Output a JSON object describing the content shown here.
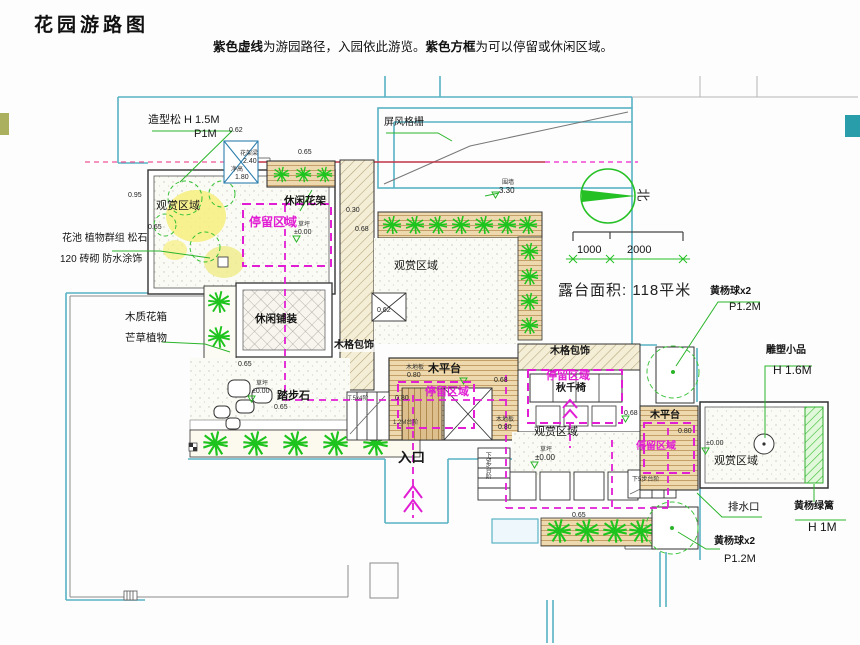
{
  "title": "花园游路图",
  "legend": {
    "bold1": "紫色虚线",
    "text1": "为游园路径，入园依此游览。",
    "bold2": "紫色方框",
    "text2": "为可以停留或休闲区域。"
  },
  "stats": {
    "terrace_area": "露台面积: 118平米"
  },
  "scalebar": {
    "left": "1000",
    "right": "2000"
  },
  "compass": {
    "north": "北"
  },
  "labels": {
    "zaoxingsong": "造型松 H 1.5M",
    "p1m": "P1M",
    "pingfeng": "屏风格栅",
    "guanshang": "观赏区域",
    "huachi": "花池 植物群组 松石",
    "zhuanqi": "120 砖砌 防水涂饰",
    "muzhihuaxiang": "木质花箱",
    "mangcao": "芒草植物",
    "xiuxianhuajia": "休闲花架",
    "xiuxianpuzhuang": "休闲铺装",
    "tingliu": "停留区域",
    "qiuqianyi": "秋千椅",
    "tabushi": "踏步石",
    "rukou": "入口",
    "mugebaoshi": "木格包饰",
    "mupingtai": "木平台",
    "paishuikou": "排水口",
    "diaosu": "雕塑小品",
    "diaosu_h": "H 1.6M",
    "huangyangqiu": "黄杨球x2",
    "p12m": "P1.2M",
    "lvli": "黄杨绿篱",
    "lvli_h": "H 1M",
    "qiangding": "围墙",
    "caoping": "草坪",
    "mudiban": "木地板",
    "huajialiang": "花架梁",
    "jinggao": "净高",
    "v330": "3.30",
    "v240": "2.40",
    "v180": "1.80",
    "v095": "0.95",
    "v030": "0.30",
    "v062": "0.62",
    "v065": "0.65",
    "v068": "0.68",
    "v080": "0.80",
    "pm000": "±0.00",
    "t2m": "1.2M台阶",
    "t5x4": "T.5x4阶",
    "xia5": "下5步台阶"
  },
  "colors": {
    "route_path": "#e11ed4",
    "section_line": "#c23347",
    "plant_green": "#1ec41e",
    "boundary_teal": "#58b2c4"
  }
}
